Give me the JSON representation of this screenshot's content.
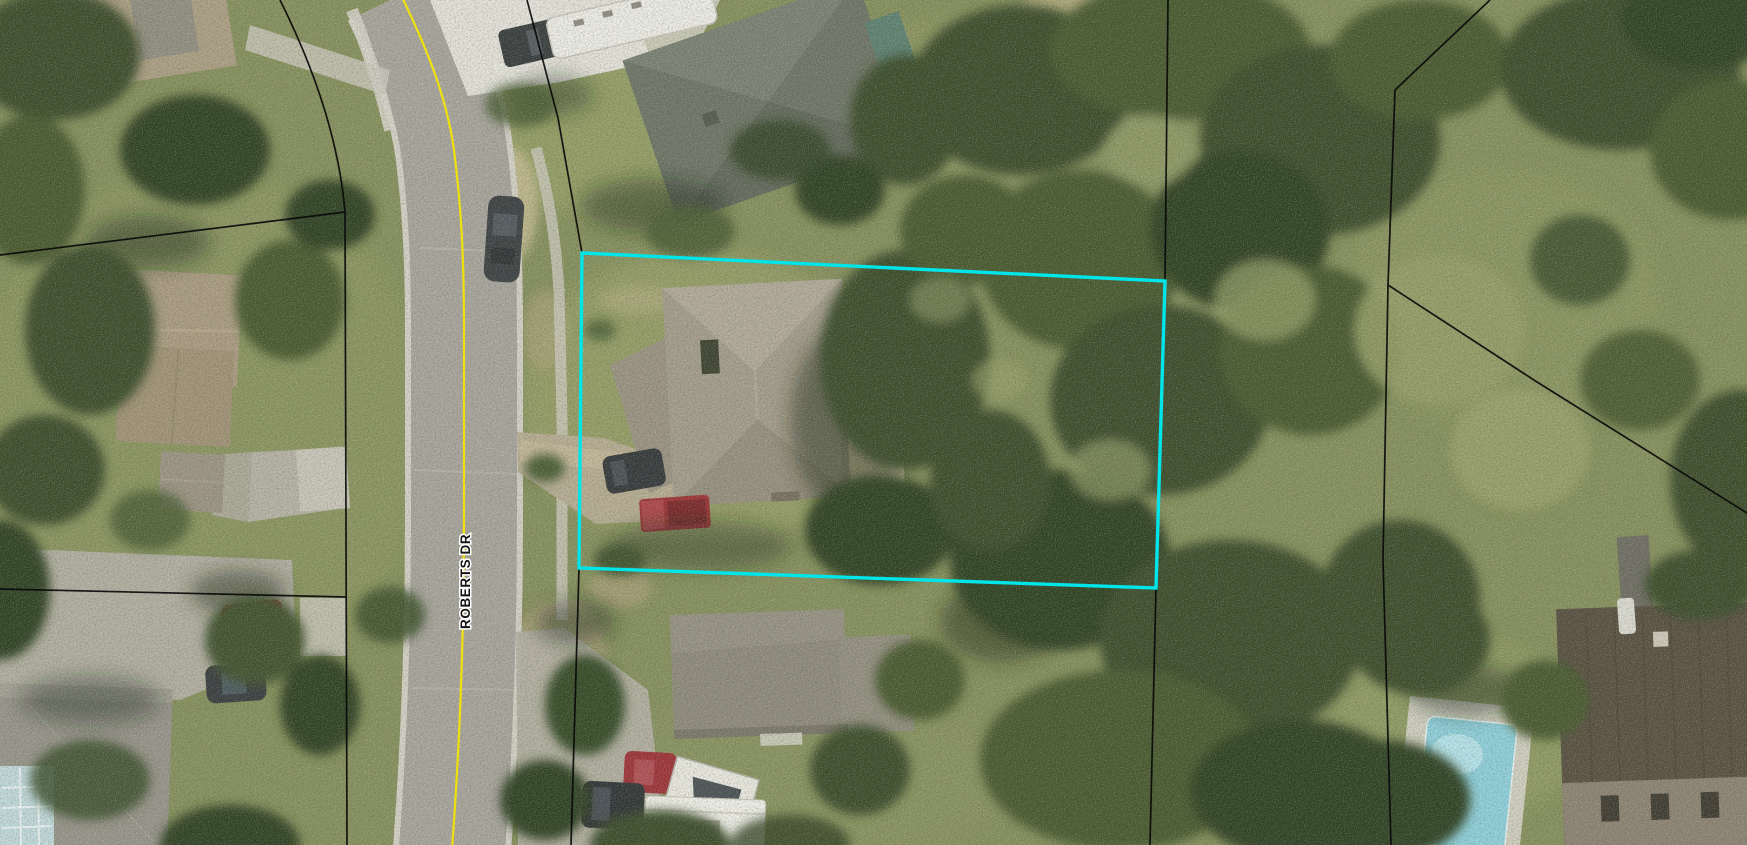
{
  "map": {
    "road_label": "ROBERTS DR",
    "highlight_color": "#00E5E9",
    "boundary_color": "#0a0a0a",
    "centerline_color": "#EFE10C",
    "highlighted_parcel_points": "582,253 1165,281 1156,588 579,568"
  }
}
